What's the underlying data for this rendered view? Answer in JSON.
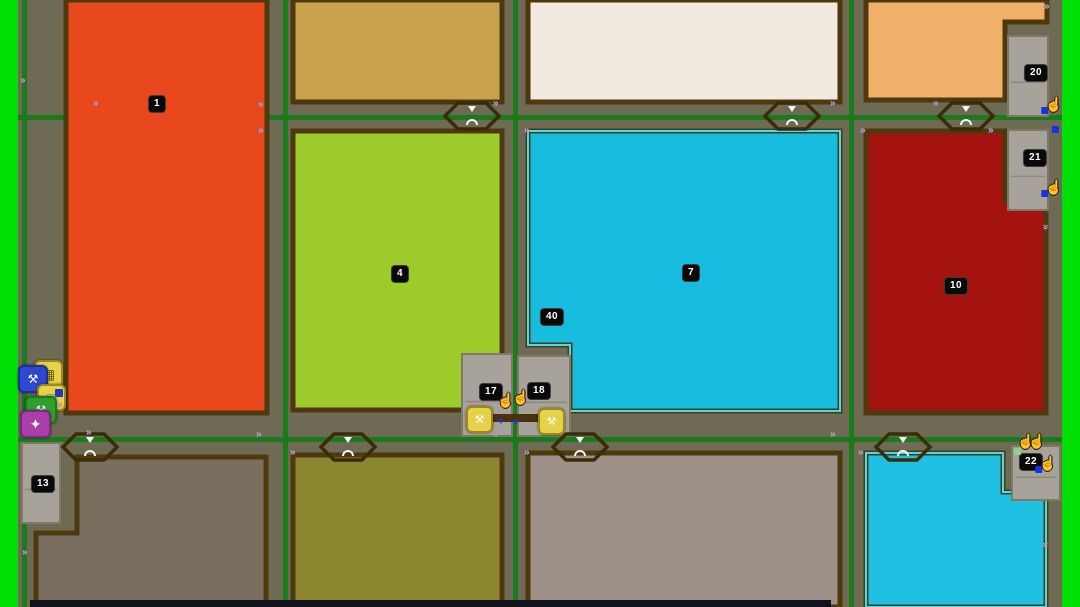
{
  "map": {
    "title": "field-overview-map",
    "canvas": {
      "width": 1080,
      "height": 607
    },
    "colors": {
      "road_base": "#6F6A54",
      "screen_edge_green": "#00DF06",
      "road_line_green": "#1B7A1E",
      "field_border_brown": "#4E390F",
      "selection_outline_cyan": "#45DCF2",
      "concrete_plot": "#A8A39A",
      "concrete_plot_border": "#7E7966",
      "badge_bg": "#0A0A0A",
      "badge_text": "#FFFFFF",
      "bottom_bar": "#11121C"
    },
    "edge_strips": [
      {
        "name": "left-green-edge",
        "x": 0,
        "y": 0,
        "w": 18,
        "h": 607
      },
      {
        "name": "right-green-edge",
        "x": 1062,
        "y": 0,
        "w": 18,
        "h": 607
      }
    ],
    "road_lines": {
      "vertical_x": [
        22,
        283,
        513,
        849
      ],
      "horizontal_y": [
        115,
        437
      ],
      "thickness": 5
    },
    "fields": [
      {
        "name": "field-1",
        "number": "1",
        "color": "#E8481C",
        "selected": false,
        "points": [
          [
            66,
            0
          ],
          [
            267,
            0
          ],
          [
            267,
            413
          ],
          [
            66,
            413
          ]
        ]
      },
      {
        "name": "field-tan-top",
        "number": "",
        "color": "#C8A24C",
        "selected": false,
        "points": [
          [
            293,
            0
          ],
          [
            502,
            0
          ],
          [
            502,
            102
          ],
          [
            293,
            102
          ]
        ]
      },
      {
        "name": "field-cream-top",
        "number": "",
        "color": "#F2EAE1",
        "selected": false,
        "points": [
          [
            528,
            0
          ],
          [
            840,
            0
          ],
          [
            840,
            102
          ],
          [
            528,
            102
          ]
        ]
      },
      {
        "name": "field-peach-top",
        "number": "",
        "color": "#F0B06A",
        "selected": false,
        "points": [
          [
            866,
            0
          ],
          [
            1047,
            0
          ],
          [
            1047,
            22
          ],
          [
            1005,
            22
          ],
          [
            1005,
            100
          ],
          [
            866,
            100
          ]
        ]
      },
      {
        "name": "field-4",
        "number": "4",
        "color": "#9CCB2B",
        "selected": false,
        "points": [
          [
            293,
            131
          ],
          [
            502,
            131
          ],
          [
            502,
            410
          ],
          [
            293,
            410
          ]
        ]
      },
      {
        "name": "field-7",
        "number": "7",
        "color": "#17BCDE",
        "selected": true,
        "points": [
          [
            528,
            131
          ],
          [
            840,
            131
          ],
          [
            840,
            411
          ],
          [
            570,
            411
          ],
          [
            570,
            345
          ],
          [
            528,
            345
          ]
        ]
      },
      {
        "name": "field-10",
        "number": "10",
        "color": "#A41310",
        "selected": false,
        "points": [
          [
            866,
            131
          ],
          [
            1005,
            131
          ],
          [
            1005,
            200
          ],
          [
            1046,
            200
          ],
          [
            1046,
            413
          ],
          [
            866,
            413
          ]
        ]
      },
      {
        "name": "field-bottom-left",
        "number": "",
        "color": "#7A6E60",
        "selected": false,
        "points": [
          [
            77,
            457
          ],
          [
            266,
            457
          ],
          [
            266,
            607
          ],
          [
            36,
            607
          ],
          [
            36,
            533
          ],
          [
            77,
            533
          ]
        ]
      },
      {
        "name": "field-olive-bottom",
        "number": "",
        "color": "#8B862F",
        "selected": false,
        "points": [
          [
            293,
            455
          ],
          [
            502,
            455
          ],
          [
            502,
            607
          ],
          [
            293,
            607
          ]
        ]
      },
      {
        "name": "field-gray-bottom",
        "number": "",
        "color": "#9C9089",
        "selected": false,
        "points": [
          [
            528,
            453
          ],
          [
            840,
            453
          ],
          [
            840,
            607
          ],
          [
            528,
            607
          ]
        ]
      },
      {
        "name": "field-cyan-bottom",
        "number": "",
        "color": "#1FC0E2",
        "selected": true,
        "points": [
          [
            866,
            453
          ],
          [
            1003,
            453
          ],
          [
            1003,
            492
          ],
          [
            1046,
            492
          ],
          [
            1046,
            607
          ],
          [
            866,
            607
          ]
        ]
      }
    ],
    "plots": [
      {
        "name": "plot-13",
        "x": 22,
        "y": 443,
        "w": 38,
        "h": 80
      },
      {
        "name": "plot-17",
        "x": 462,
        "y": 354,
        "w": 50,
        "h": 82
      },
      {
        "name": "plot-18",
        "x": 518,
        "y": 356,
        "w": 52,
        "h": 80
      },
      {
        "name": "plot-20",
        "x": 1008,
        "y": 36,
        "w": 40,
        "h": 80
      },
      {
        "name": "plot-21",
        "x": 1008,
        "y": 130,
        "w": 40,
        "h": 80
      },
      {
        "name": "plot-22",
        "x": 1012,
        "y": 446,
        "w": 48,
        "h": 54
      }
    ],
    "badges": [
      {
        "label": "1",
        "x": 157,
        "y": 104
      },
      {
        "label": "4",
        "x": 400,
        "y": 274
      },
      {
        "label": "7",
        "x": 691,
        "y": 273
      },
      {
        "label": "40",
        "x": 552,
        "y": 317
      },
      {
        "label": "10",
        "x": 956,
        "y": 286
      },
      {
        "label": "13",
        "x": 43,
        "y": 484
      },
      {
        "label": "17",
        "x": 491,
        "y": 392
      },
      {
        "label": "18",
        "x": 539,
        "y": 391
      },
      {
        "label": "20",
        "x": 1036,
        "y": 73
      },
      {
        "label": "21",
        "x": 1035,
        "y": 158
      },
      {
        "label": "22",
        "x": 1031,
        "y": 462
      }
    ],
    "junctions": [
      {
        "x": 472,
        "y": 116
      },
      {
        "x": 792,
        "y": 116
      },
      {
        "x": 966,
        "y": 116
      },
      {
        "x": 90,
        "y": 447
      },
      {
        "x": 348,
        "y": 447
      },
      {
        "x": 580,
        "y": 447
      },
      {
        "x": 903,
        "y": 447
      }
    ],
    "extra_rects": [
      {
        "name": "path-segment",
        "x": 476,
        "y": 414,
        "w": 74,
        "h": 8,
        "color": "#4A3110"
      },
      {
        "name": "bottom-bar",
        "x": 30,
        "y": 600,
        "w": 801,
        "h": 7,
        "color": "#11121C"
      }
    ],
    "icons": [
      {
        "name": "storage-icon",
        "x": 34,
        "y": 360,
        "w": 25,
        "h": 24,
        "bg": "#E6D24A",
        "border": "#A08818",
        "glyph": "▦",
        "glyph_color": "#6B5A10",
        "size": 14
      },
      {
        "name": "implement-blue-icon",
        "x": 18,
        "y": 365,
        "w": 26,
        "h": 24,
        "bg": "#2E49D0",
        "border": "#1A2F9E",
        "glyph": "⚒",
        "glyph_color": "#FFFFFF",
        "size": 12
      },
      {
        "name": "vehicle-icon",
        "x": 37,
        "y": 384,
        "w": 25,
        "h": 23,
        "bg": "#E6D24A",
        "border": "#A08818",
        "glyph": "▤",
        "glyph_color": "#8A8A88",
        "size": 12
      },
      {
        "name": "harvester-icon",
        "x": 25,
        "y": 396,
        "w": 28,
        "h": 24,
        "bg": "#2FA02F",
        "border": "#1C7A1C",
        "glyph": "⚒",
        "glyph_color": "#E8E8E8",
        "size": 12
      },
      {
        "name": "player-marker-icon",
        "x": 20,
        "y": 410,
        "w": 27,
        "h": 24,
        "bg": "#AA3FAA",
        "border": "#7A2B7A",
        "glyph": "✦",
        "glyph_color": "#FFFFFF",
        "size": 14
      },
      {
        "name": "tool-marker-17-icon",
        "x": 466,
        "y": 406,
        "w": 23,
        "h": 23,
        "bg": "#E6D24A",
        "border": "#A08818",
        "glyph": "⚒",
        "glyph_color": "#FFFFFF",
        "size": 11
      },
      {
        "name": "tool-marker-18-icon",
        "x": 538,
        "y": 408,
        "w": 23,
        "h": 23,
        "bg": "#E6D24A",
        "border": "#A08818",
        "glyph": "⚒",
        "glyph_color": "#FFFFFF",
        "size": 11
      }
    ],
    "hand_cursors": [
      {
        "x": 506,
        "y": 400,
        "blue": false
      },
      {
        "x": 521,
        "y": 397,
        "blue": false
      },
      {
        "x": 1054,
        "y": 104,
        "blue": true
      },
      {
        "x": 1054,
        "y": 187,
        "blue": true
      },
      {
        "x": 1026,
        "y": 441,
        "blue": false
      },
      {
        "x": 1037,
        "y": 441,
        "blue": false
      },
      {
        "x": 1048,
        "y": 463,
        "blue": true
      }
    ],
    "blue_arrows": [
      {
        "x": 496,
        "y": 416,
        "rot": 195,
        "color": "#1734E4",
        "glyph": "➤"
      },
      {
        "x": 512,
        "y": 417,
        "rot": 195,
        "color": "#1734E4",
        "glyph": "➤"
      }
    ],
    "dots": [
      {
        "x": 1052,
        "y": 126,
        "size": 7,
        "color": "#1733E0"
      },
      {
        "x": 1014,
        "y": 448,
        "size": 7,
        "color": "#8FD08F"
      },
      {
        "x": 55,
        "y": 389,
        "size": 8,
        "color": "#2038C8"
      }
    ],
    "road_markers": [
      {
        "x": 20,
        "y": 76,
        "rot": 0
      },
      {
        "x": 93,
        "y": 99,
        "rot": 0
      },
      {
        "x": 258,
        "y": 100,
        "rot": 0
      },
      {
        "x": 258,
        "y": 126,
        "rot": 0
      },
      {
        "x": 493,
        "y": 99,
        "rot": 0
      },
      {
        "x": 524,
        "y": 126,
        "rot": 0
      },
      {
        "x": 830,
        "y": 99,
        "rot": 0
      },
      {
        "x": 860,
        "y": 126,
        "rot": 0
      },
      {
        "x": 933,
        "y": 99,
        "rot": 0
      },
      {
        "x": 988,
        "y": 126,
        "rot": 0
      },
      {
        "x": 1044,
        "y": 2,
        "rot": 0
      },
      {
        "x": 1042,
        "y": 222,
        "rot": 90
      },
      {
        "x": 86,
        "y": 428,
        "rot": 0
      },
      {
        "x": 256,
        "y": 430,
        "rot": 0
      },
      {
        "x": 290,
        "y": 448,
        "rot": 0
      },
      {
        "x": 493,
        "y": 430,
        "rot": 0
      },
      {
        "x": 524,
        "y": 448,
        "rot": 0
      },
      {
        "x": 830,
        "y": 430,
        "rot": 0
      },
      {
        "x": 858,
        "y": 448,
        "rot": 0
      },
      {
        "x": 1042,
        "y": 540,
        "rot": 90
      },
      {
        "x": 22,
        "y": 548,
        "rot": 0
      },
      {
        "x": 56,
        "y": 400,
        "rot": 90
      }
    ]
  }
}
